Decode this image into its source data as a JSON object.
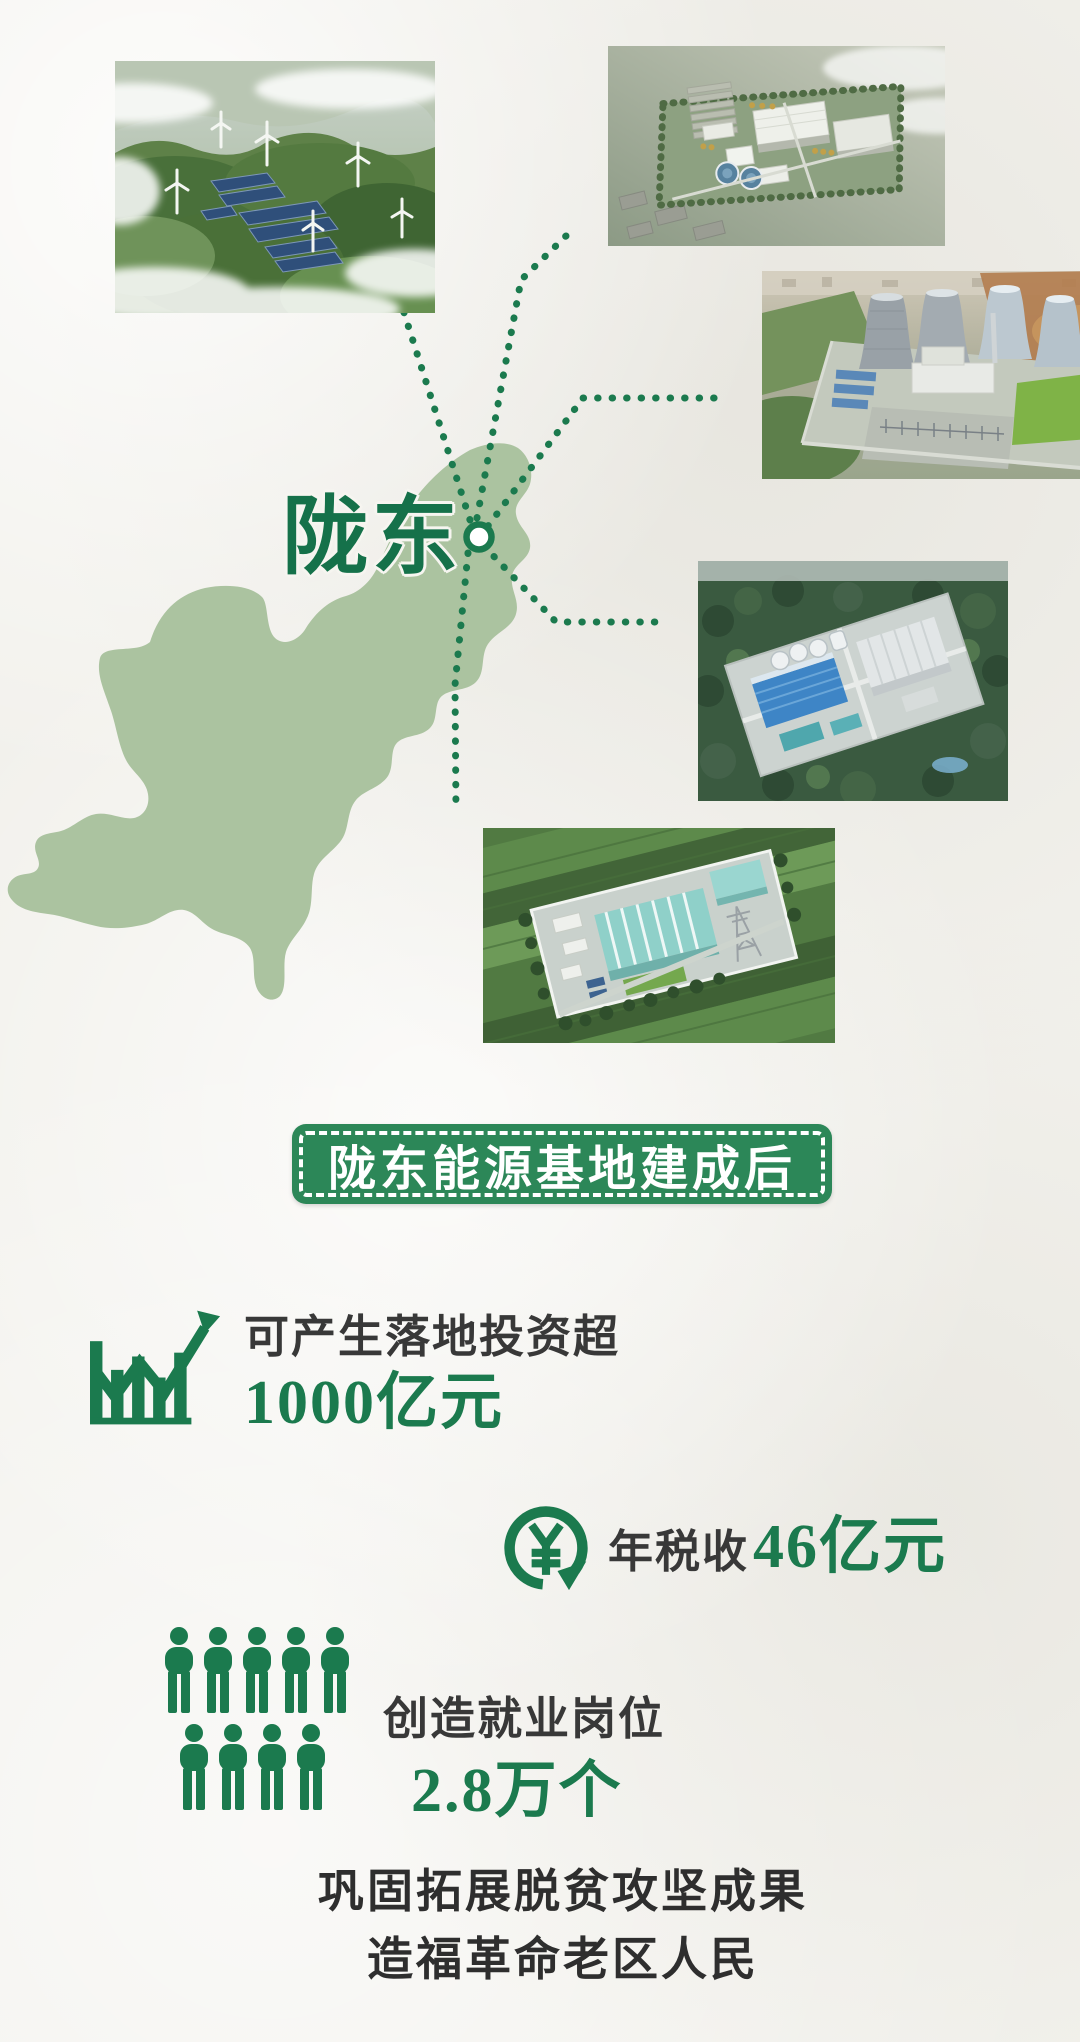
{
  "colors": {
    "background": "#f2f1ec",
    "map_green": "#abc3a0",
    "accent_green": "#1b7a4e",
    "banner_green": "#2c8758",
    "dark_text": "#383838"
  },
  "map": {
    "region_label": "陇东",
    "marker": "location-marker"
  },
  "photos": [
    {
      "name": "wind-solar-farm-photo"
    },
    {
      "name": "industrial-park-photo"
    },
    {
      "name": "coal-power-plant-photo"
    },
    {
      "name": "gas-facility-photo"
    },
    {
      "name": "substation-photo"
    }
  ],
  "title_banner": {
    "text": "陇东能源基地建成后"
  },
  "stats": [
    {
      "icon": "bar-chart-growth-icon",
      "label": "可产生落地投资超",
      "value": "1000亿元"
    },
    {
      "icon": "yuan-circulation-icon",
      "label": "年税收",
      "value": "46亿元"
    },
    {
      "icon": "people-grid-icon",
      "label": "创造就业岗位",
      "value": "2.8万个"
    }
  ],
  "footer": {
    "line1": "巩固拓展脱贫攻坚成果",
    "line2": "造福革命老区人民"
  }
}
